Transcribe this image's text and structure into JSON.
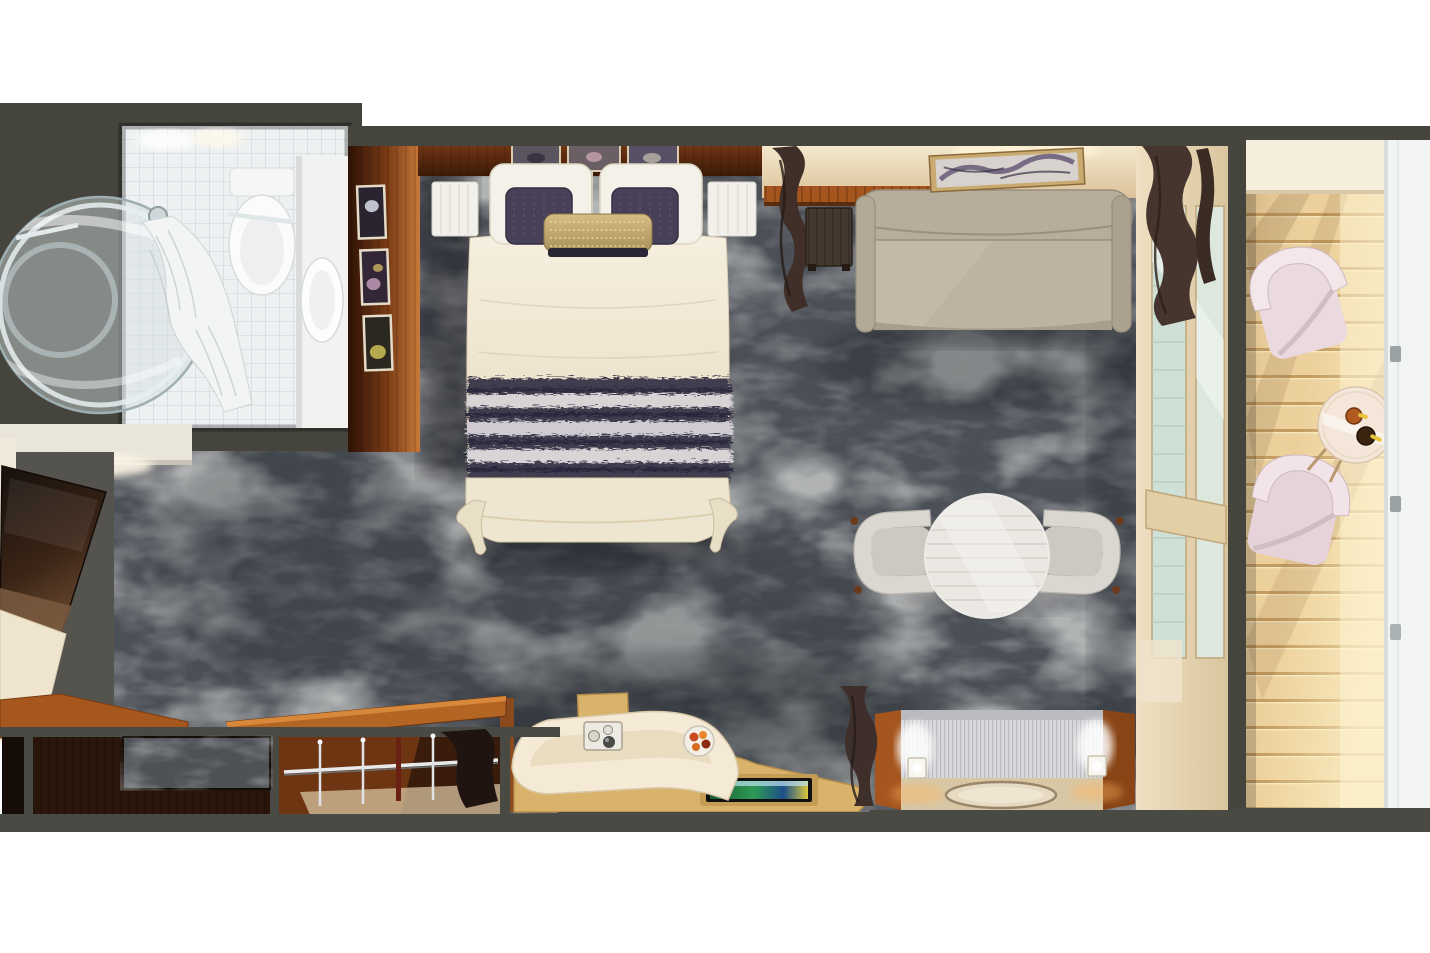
{
  "scene": {
    "kind": "top-down 3D rendered floor plan of a balcony stateroom",
    "width_px": 1430,
    "height_px": 953,
    "background": "#ffffff"
  },
  "palette": {
    "wall_dark": "#45453e",
    "carpet_base": "#4b4f56",
    "carpet_marble": "#9aa0a5",
    "wood_dark": "#5a2c12",
    "wood_orange": "#a5561e",
    "wood_light": "#d9b36b",
    "cream_wall": "#f0e4ca",
    "linen": "#f2e9d8",
    "pillow_dark": "#474057",
    "pillow_gold": "#c8ae76",
    "blanket_navy": "#403c50",
    "blanket_stripe": "#d8d4d6",
    "sofa": "#b5ab9b",
    "curtain": "#443329",
    "table_white": "#ebe8e3",
    "chair_gray": "#d9d5cf",
    "tile": "#eef1f1",
    "deck": "#ecd09c",
    "balcony_chair": "#ecdfe3",
    "glass": "#cfe0d6",
    "railing": "#f2f4f4"
  },
  "rooms": {
    "bathroom": {
      "label": "Bathroom",
      "items": {
        "walls": "Bathroom walls",
        "tile_floor": "White tile floor",
        "shower": "Round glass shower",
        "shower_curtain": "Shower curtain",
        "shower_head": "Shower head",
        "towel_bar": "Towel bar",
        "toilet": "Toilet",
        "vanity": "Vanity counter with sink",
        "ceiling_lights": "Ceiling lights"
      }
    },
    "bedroom": {
      "label": "Bedroom",
      "items": {
        "carpet": "Patterned gray carpet",
        "headboard_wall": "Dark wood headboard wall",
        "side_wall_art": "Framed pictures on side wall",
        "bed_art": "Framed pictures above bed",
        "bed": "Bed with cream duvet",
        "pillows_white": "White pillows",
        "pillows_dark": "Dark accent pillows",
        "pillow_gold": "Gold bolster pillow",
        "blanket": "Striped foot blanket",
        "nightstand_left": "Nightstand",
        "nightstand_right": "Nightstand",
        "window_curtain": "Dark curtain",
        "side_table": "Dark side table"
      }
    },
    "sitting_area": {
      "label": "Sitting area",
      "items": {
        "sofa": "Upholstered sofa",
        "artwork": "Framed artwork above sofa",
        "accent_wall": "Lit cream wall with wood slats",
        "dining_table": "Round table",
        "chair_left": "Upholstered chair",
        "chair_right": "Upholstered chair",
        "credenza": "Credenza with wood ends",
        "lamp_left": "Glowing cube lamp",
        "lamp_right": "Glowing cube lamp",
        "tray": "Oval tray",
        "door_curtain_top": "Dark curtain at balcony door",
        "door_curtain_bottom": "Dark curtain at balcony door"
      }
    },
    "entry": {
      "label": "Entry and wardrobe",
      "items": {
        "tv": "Wall-mounted TV",
        "tv_cabinet": "Cream cabinet",
        "counter": "Wood counter",
        "cabinets": "Dark wood cabinets",
        "marble_inset": "Stone inset",
        "wardrobe": "Wardrobe with hanging rail",
        "hangers": "Hangers on rail",
        "garment": "Hanging garment",
        "desk": "Vanity desk with curved seat",
        "desk_seat": "Cream upholstered seat",
        "desk_screen": "Tablet screen on desk",
        "plate": "Plate of food",
        "coffee_tray": "Tray with cups",
        "desk_curtain": "Dark curtain"
      }
    },
    "door_wall": {
      "label": "Sliding glass balcony door",
      "items": {
        "frame": "Cream door frame",
        "glass": "Glass panels",
        "stile": "Door stile"
      }
    },
    "balcony": {
      "label": "Balcony",
      "items": {
        "deck": "Sunlit wood plank deck",
        "overhang": "Ceiling edge",
        "chair_top": "Balcony chair",
        "chair_bottom": "Balcony chair",
        "table": "Round balcony table",
        "drinks": "Two bottled drinks",
        "railing": "Glass railing"
      }
    }
  }
}
